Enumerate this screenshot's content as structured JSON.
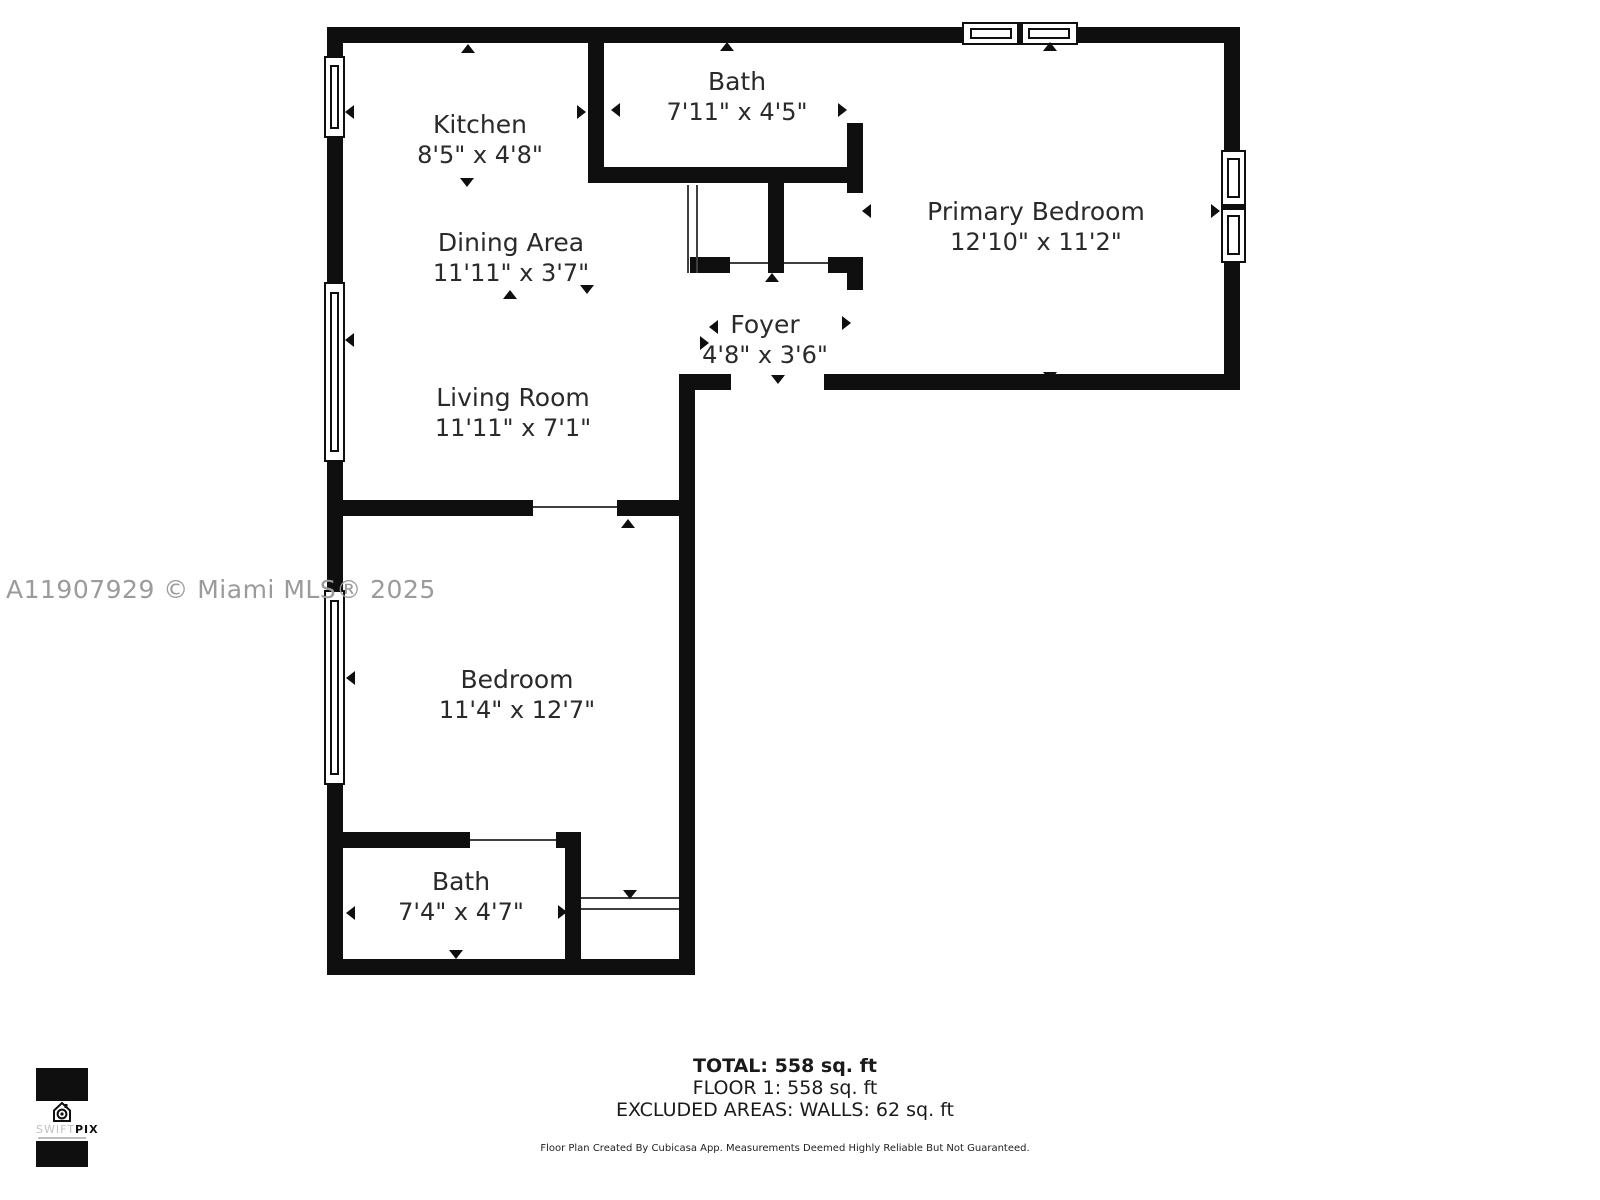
{
  "watermark": "A11907929 © Miami MLS® 2025",
  "rooms": {
    "kitchen": {
      "name": "Kitchen",
      "dims": "8'5\" x 4'8\""
    },
    "bath_top": {
      "name": "Bath",
      "dims": "7'11\" x 4'5\""
    },
    "primary_bedroom": {
      "name": "Primary Bedroom",
      "dims": "12'10\" x 11'2\""
    },
    "dining": {
      "name": "Dining Area",
      "dims": "11'11\" x 3'7\""
    },
    "foyer": {
      "name": "Foyer",
      "dims": "4'8\" x 3'6\""
    },
    "living": {
      "name": "Living Room",
      "dims": "11'11\" x 7'1\""
    },
    "bedroom": {
      "name": "Bedroom",
      "dims": "11'4\" x 12'7\""
    },
    "bath_bottom": {
      "name": "Bath",
      "dims": "7'4\" x 4'7\""
    }
  },
  "summary": {
    "total": "TOTAL: 558 sq. ft",
    "floor": "FLOOR 1: 558 sq. ft",
    "excluded": "EXCLUDED AREAS: WALLS: 62 sq. ft",
    "disclaimer": "Floor Plan Created By Cubicasa App. Measurements Deemed Highly Reliable But Not Guaranteed."
  },
  "logo": {
    "brand_left": "SWIFT",
    "brand_right": "PIX"
  },
  "colors": {
    "wall": "#0f0f0f",
    "watermark": "#9b9b9b",
    "label_text": "#2a2a2a"
  }
}
